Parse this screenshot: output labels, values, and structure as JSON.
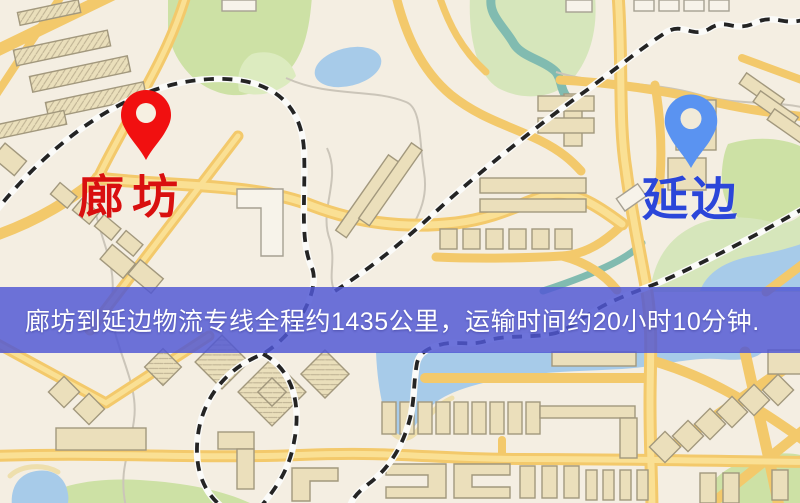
{
  "banner": {
    "text": "廊坊到延边物流专线全程约1435公里，运输时间约20小时10分钟.",
    "background_color": "#5158d4",
    "text_color": "#ffffff"
  },
  "origin": {
    "name": "廊坊",
    "pin_color": "#ee1111",
    "label_color": "#d90f0f"
  },
  "destination": {
    "name": "延边",
    "pin_color": "#5b93ef",
    "label_color": "#2b46d9"
  },
  "route": {
    "distance_text": "约1435公里",
    "duration_text": "约20小时10分钟"
  },
  "map_colors": {
    "background": "#f4eee2",
    "road": "#f2c96d",
    "park": "#cde1a6",
    "water": "#a8cbe8",
    "railway": "#242424",
    "building": "#ebdfbc"
  }
}
